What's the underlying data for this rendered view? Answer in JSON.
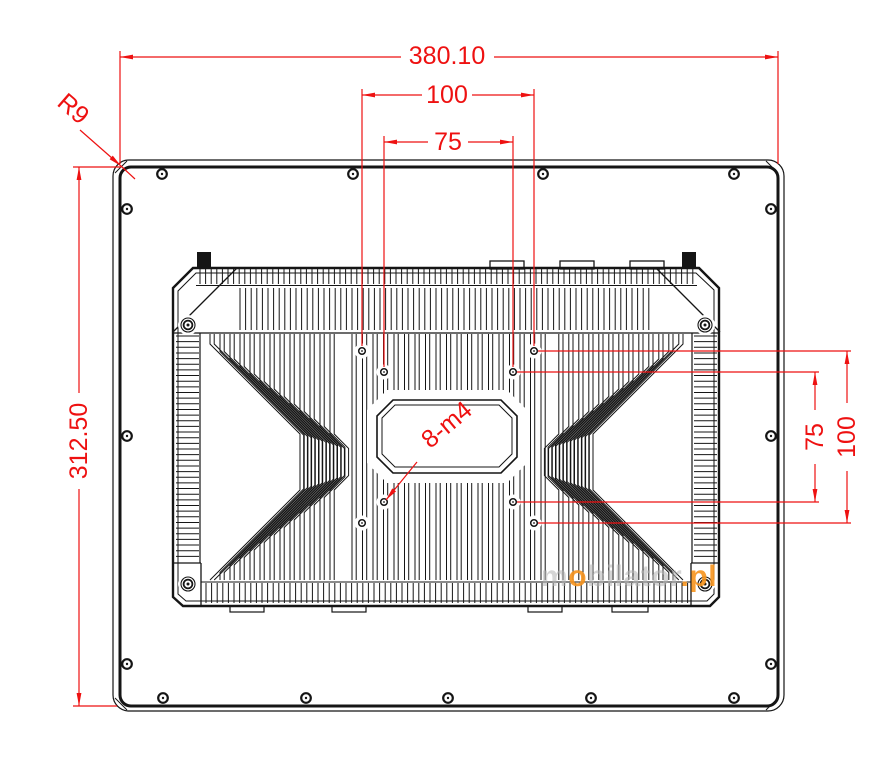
{
  "dimensions": {
    "overall_width": "380.10",
    "overall_height": "312.50",
    "vesa_top_100": "100",
    "vesa_top_75": "75",
    "vesa_right_75": "75",
    "vesa_right_100": "100",
    "corner_radius": "R9",
    "thread_label": "8-m4"
  },
  "watermark": {
    "part_m": "m",
    "part_o": "o",
    "part_bilator": "bilator",
    "part_pl": ".pl"
  },
  "colors": {
    "dimension_red": "#ee1111",
    "ink": "#151515",
    "watermark_gray": "#b4b4b4",
    "watermark_orange": "#f7941d"
  }
}
